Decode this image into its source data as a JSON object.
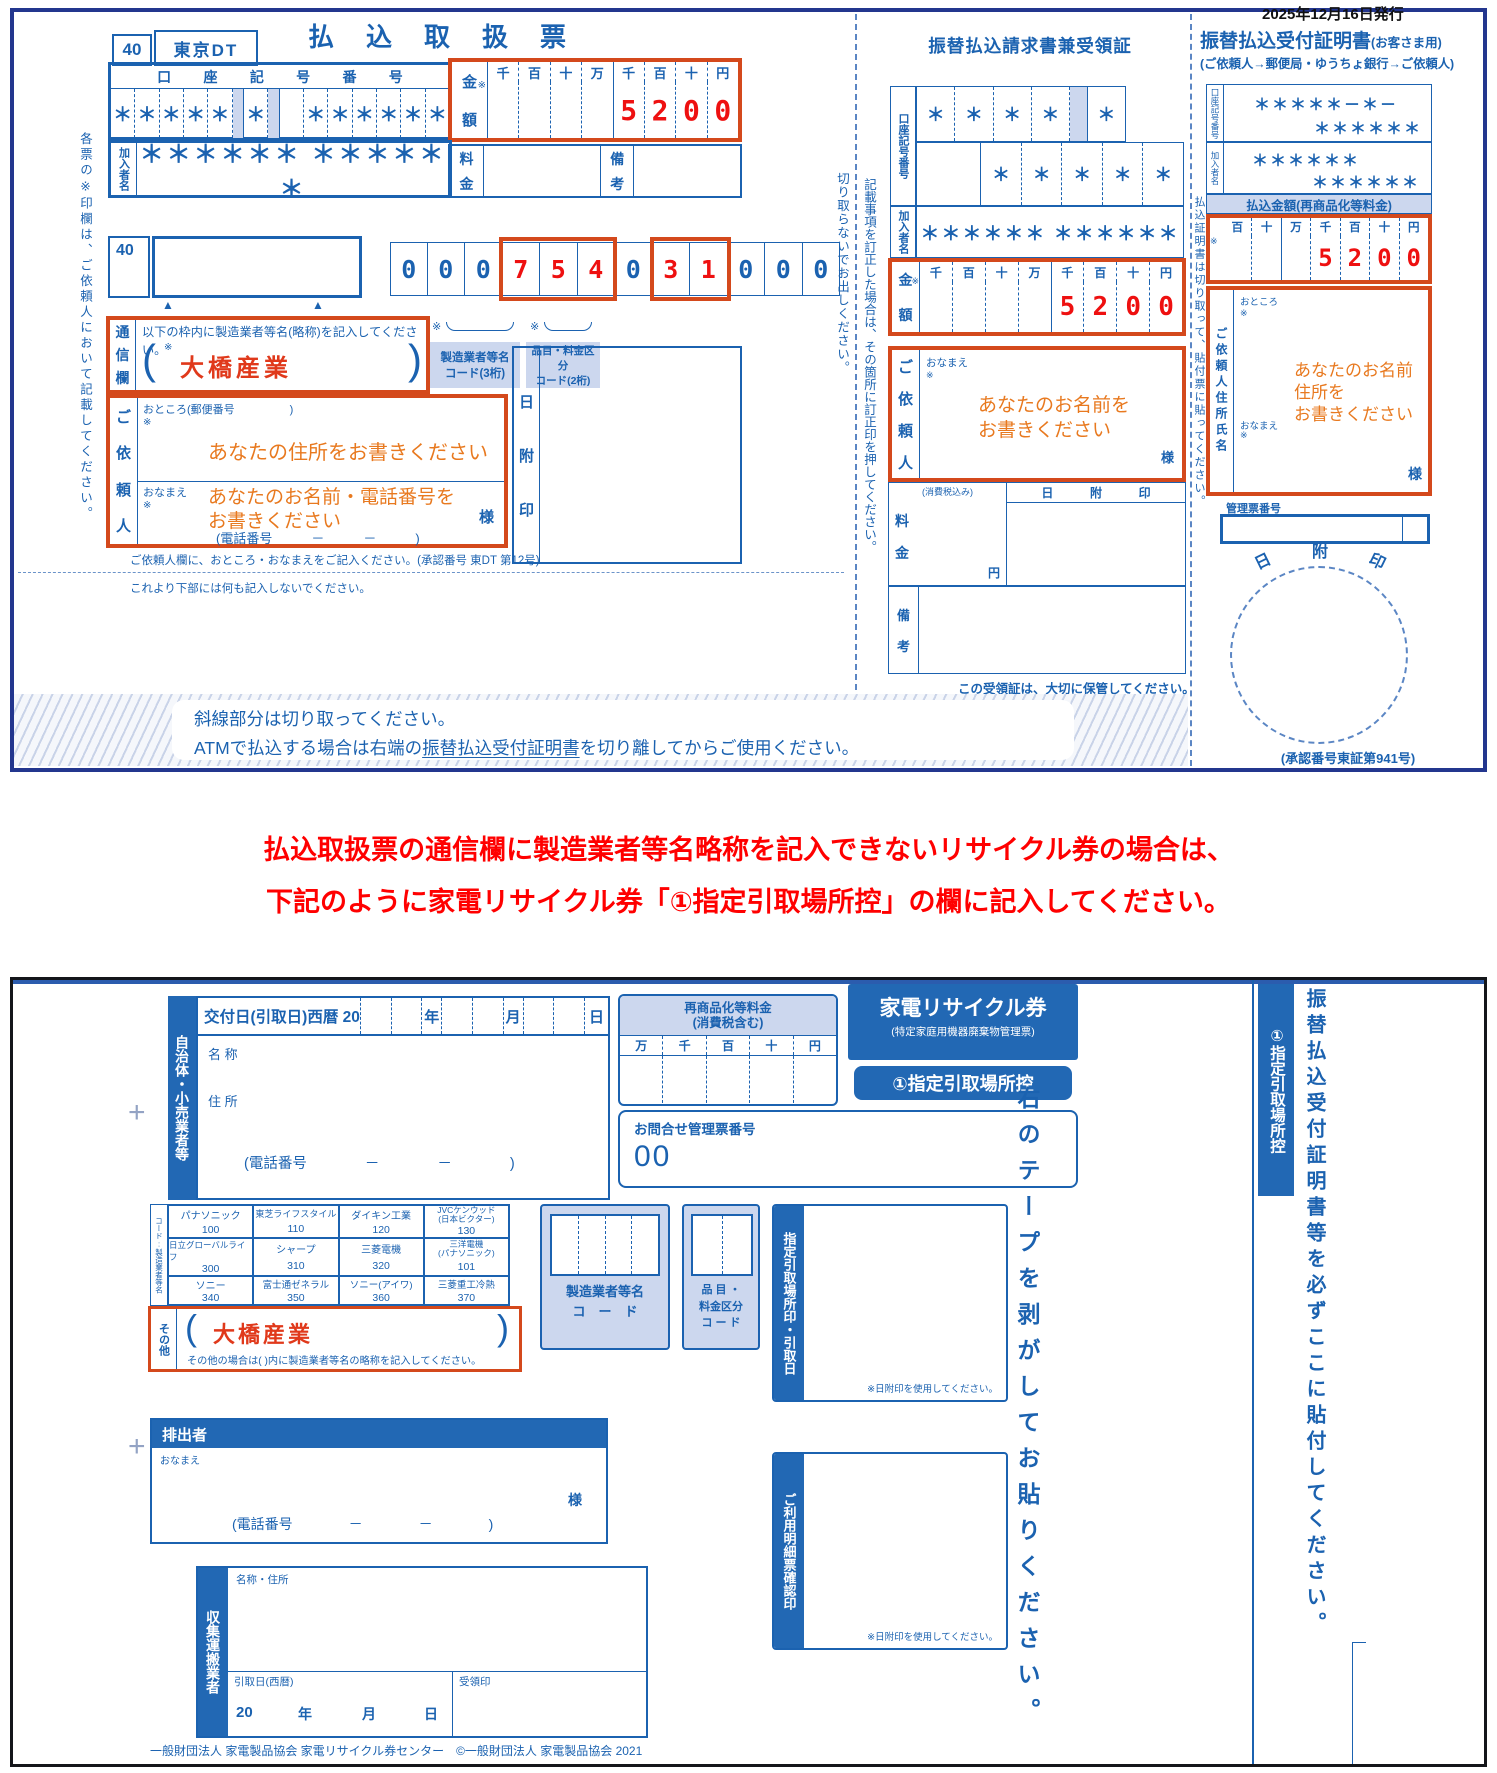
{
  "palette": {
    "form_blue": "#1b62b0",
    "outer_navy": "#23368e",
    "field_red_box": "#d4491c",
    "digit_red": "#ee1010",
    "hint_orange": "#e8791f",
    "label_bg": "#ccd7ee",
    "header_fill": "#2268b4"
  },
  "ui": {
    "arrow": "▲",
    "ref_mark": "※",
    "reg_mark": "+"
  },
  "top_form": {
    "slip": {
      "bank_code": "40",
      "office": "東京DT",
      "title": "払込取扱票",
      "account_label": "口座記号番号",
      "account_cells": [
        "＊",
        "＊",
        "＊",
        "＊",
        "＊",
        "",
        "＊",
        "",
        "",
        "＊",
        "＊",
        "＊",
        "＊",
        "＊",
        "＊"
      ],
      "member_label": "加入者名",
      "member_value": "＊＊＊＊＊＊ ＊＊＊＊＊＊",
      "amount_label": "金額",
      "amount_cols": "千百十万千百十円",
      "amount_digits": [
        "",
        "",
        "",
        "",
        "5",
        "2",
        "0",
        "0"
      ],
      "fee_label": "料金",
      "remarks_label": "備考",
      "code_row": {
        "code": "40",
        "digits": [
          "0",
          "0",
          "0",
          "7",
          "5",
          "4",
          "0",
          "3",
          "1",
          "0",
          "0",
          "0"
        ]
      },
      "tsushin": {
        "label": "通信欄",
        "instruction": "以下の枠内に製造業者等名(略称)を記入してください。",
        "maker_name": "大橋産業"
      },
      "maker_code_label": "製造業者等名\nコード(3桁)",
      "item_code_label": "品目・料金区分\nコード(2桁)",
      "client": {
        "label": "ご依頼人",
        "address_label": "おところ(郵便番号　　　　　)",
        "address_hint": "あなたの住所をお書きください",
        "name_label": "おなまえ",
        "name_hint": "あなたのお名前・電話番号を\nお書きください",
        "sama": "様",
        "phone": "(電話番号　　　－　　　－　　　)"
      },
      "date_stamp": "日附印",
      "note1": "ご依頼人欄に、おところ・おなまえをご記入ください。(承認番号 東DT 第12号)",
      "note2": "これより下部には何も記入しないでください。",
      "margin_note": "各票の※印欄は、ご依頼人において記載してください。"
    },
    "receipt": {
      "title": "振替払込請求書兼受領証",
      "cut_note": "切り取らないでお出しください。",
      "correction_note": "記載事項を訂正した場合は、その箇所に訂正印を押してください。",
      "account_label": "口座記号番号",
      "account_row1": [
        "＊",
        "＊",
        "＊",
        "＊",
        "",
        "＊"
      ],
      "account_row2": [
        "",
        "＊",
        "＊",
        "＊",
        "＊",
        "＊"
      ],
      "member_label": "加入者名",
      "member_value": "＊＊＊＊＊＊ ＊＊＊＊＊＊",
      "amount_label": "金額",
      "amount_cols": "千百十万千百十円",
      "amount_digits": [
        "",
        "",
        "",
        "",
        "5",
        "2",
        "0",
        "0"
      ],
      "client_label": "ご依頼人",
      "name_label": "おなまえ",
      "name_hint": "あなたのお名前を\nお書きください",
      "sama": "様",
      "fee_label": "料金",
      "tax_note": "(消費税込み)",
      "yen": "円",
      "date_stamp": "日附印",
      "remarks_label": "備考",
      "keep_note": "この受領証は、大切に保管してください。"
    },
    "certificate": {
      "issue_date": "2025年12月16日発行",
      "title": "振替払込受付証明書",
      "title_suffix": "(お客さま用)",
      "subtitle": "(ご依頼人→郵便局・ゆうちょ銀行→ご依頼人)",
      "account_label": "口座記号番号",
      "account_value1": "＊＊＊＊＊－＊－",
      "account_value2": "＊＊＊＊＊＊",
      "member_label": "加入者名",
      "member_value1": "＊＊＊＊＊＊",
      "member_value2": "＊＊＊＊＊＊",
      "amount_header": "払込金額(再商品化等料金)",
      "amount_cols": "百十万千百十円",
      "amount_digits": [
        "",
        "",
        "",
        "5",
        "2",
        "0",
        "0"
      ],
      "side_note": "払込証明書は切り取って、貼付票に貼ってください。",
      "client_label": "ご依頼人住所氏名",
      "address_label": "おところ",
      "name_label": "おなまえ",
      "hint": "あなたのお名前\n住所を\nお書きください",
      "sama": "様",
      "mgmt_label": "管理票番号",
      "date_stamp": "日附印",
      "approval": "(承認番号東証第941号)"
    },
    "banner": {
      "line1": "斜線部分は切り取ってください。",
      "line2_pre": "ATMで払込する場合は右端の",
      "line2_link": "振替払込受付証明書",
      "line2_post": "を切り離してからご使用ください。"
    }
  },
  "notice": {
    "line1": "払込取扱票の通信欄に製造業者等名略称を記入できないリサイクル券の場合は、",
    "line2": "下記のように家電リサイクル券「①指定引取場所控」の欄に記入してください。"
  },
  "bottom_form": {
    "municipality_label": "自治体・小売業者等",
    "issue_row": {
      "label": "交付日(引取日)西暦 20",
      "year": "年",
      "month": "月",
      "day": "日"
    },
    "name_label": "名 称",
    "address_label": "住 所",
    "phone": "(電話番号　　　　－　　　　－　　　　)",
    "fee_box": {
      "title": "再商品化等料金\n(消費税含む)",
      "cols": "万千百十円"
    },
    "ticket": {
      "title": "家電リサイクル券",
      "subtitle": "(特定家庭用機器廃棄物管理票)",
      "copy_label": "①指定引取場所控"
    },
    "inquiry": {
      "label": "お問合せ管理票番号",
      "value": "00"
    },
    "makers": {
      "side_label": "コード:製造業者等名",
      "rows": [
        [
          {
            "name": "パナソニック",
            "code": "100"
          },
          {
            "name": "東芝ライフスタイル",
            "code": "110"
          },
          {
            "name": "ダイキン工業",
            "code": "120"
          },
          {
            "name": "JVCケンウッド\n(日本ビクター)",
            "code": "130"
          }
        ],
        [
          {
            "name": "日立グローバルライフ",
            "code": "300"
          },
          {
            "name": "シャープ",
            "code": "310"
          },
          {
            "name": "三菱電機",
            "code": "320"
          },
          {
            "name": "三洋電機\n(パナソニック)",
            "code": "101"
          }
        ],
        [
          {
            "name": "ソニー",
            "code": "340"
          },
          {
            "name": "富士通ゼネラル",
            "code": "350"
          },
          {
            "name": "ソニー(アイワ)",
            "code": "360"
          },
          {
            "name": "三菱重工冷熱",
            "code": "370"
          }
        ]
      ],
      "other_label": "その他",
      "other_value": "大橋産業",
      "other_note": "その他の場合は( )内に製造業者等名の略称を記入してください。"
    },
    "maker_code_box": "製造業者等名\nコ　ー　ド",
    "item_code_box": "品 目 ・\n料金区分\nコ ー ド",
    "pickup_stamp": {
      "label": "指定引取場所印・引取日",
      "note": "※日附印を使用してください。"
    },
    "detail_stamp": {
      "label": "ご利用明細票確認印",
      "note": "※日附印を使用してください。"
    },
    "tape_note": "右のテープを剥がしてお貼りください。",
    "right_strip": {
      "copy_label": "①指定引取場所控",
      "paste_note": "振替払込受付証明書等を必ずここに貼付してください。"
    },
    "emitter": {
      "label": "排出者",
      "name_label": "おなまえ",
      "sama": "様",
      "phone": "(電話番号　　　　－　　　　－　　　　)"
    },
    "collector": {
      "label": "収集運搬業者",
      "name_label": "名称・住所",
      "date_label": "引取日(西暦)",
      "date_prefix": "20",
      "year": "年",
      "month": "月",
      "day": "日",
      "stamp_label": "受領印"
    },
    "footer": "一般財団法人 家電製品協会 家電リサイクル券センター　©一般財団法人 家電製品協会 2021"
  }
}
